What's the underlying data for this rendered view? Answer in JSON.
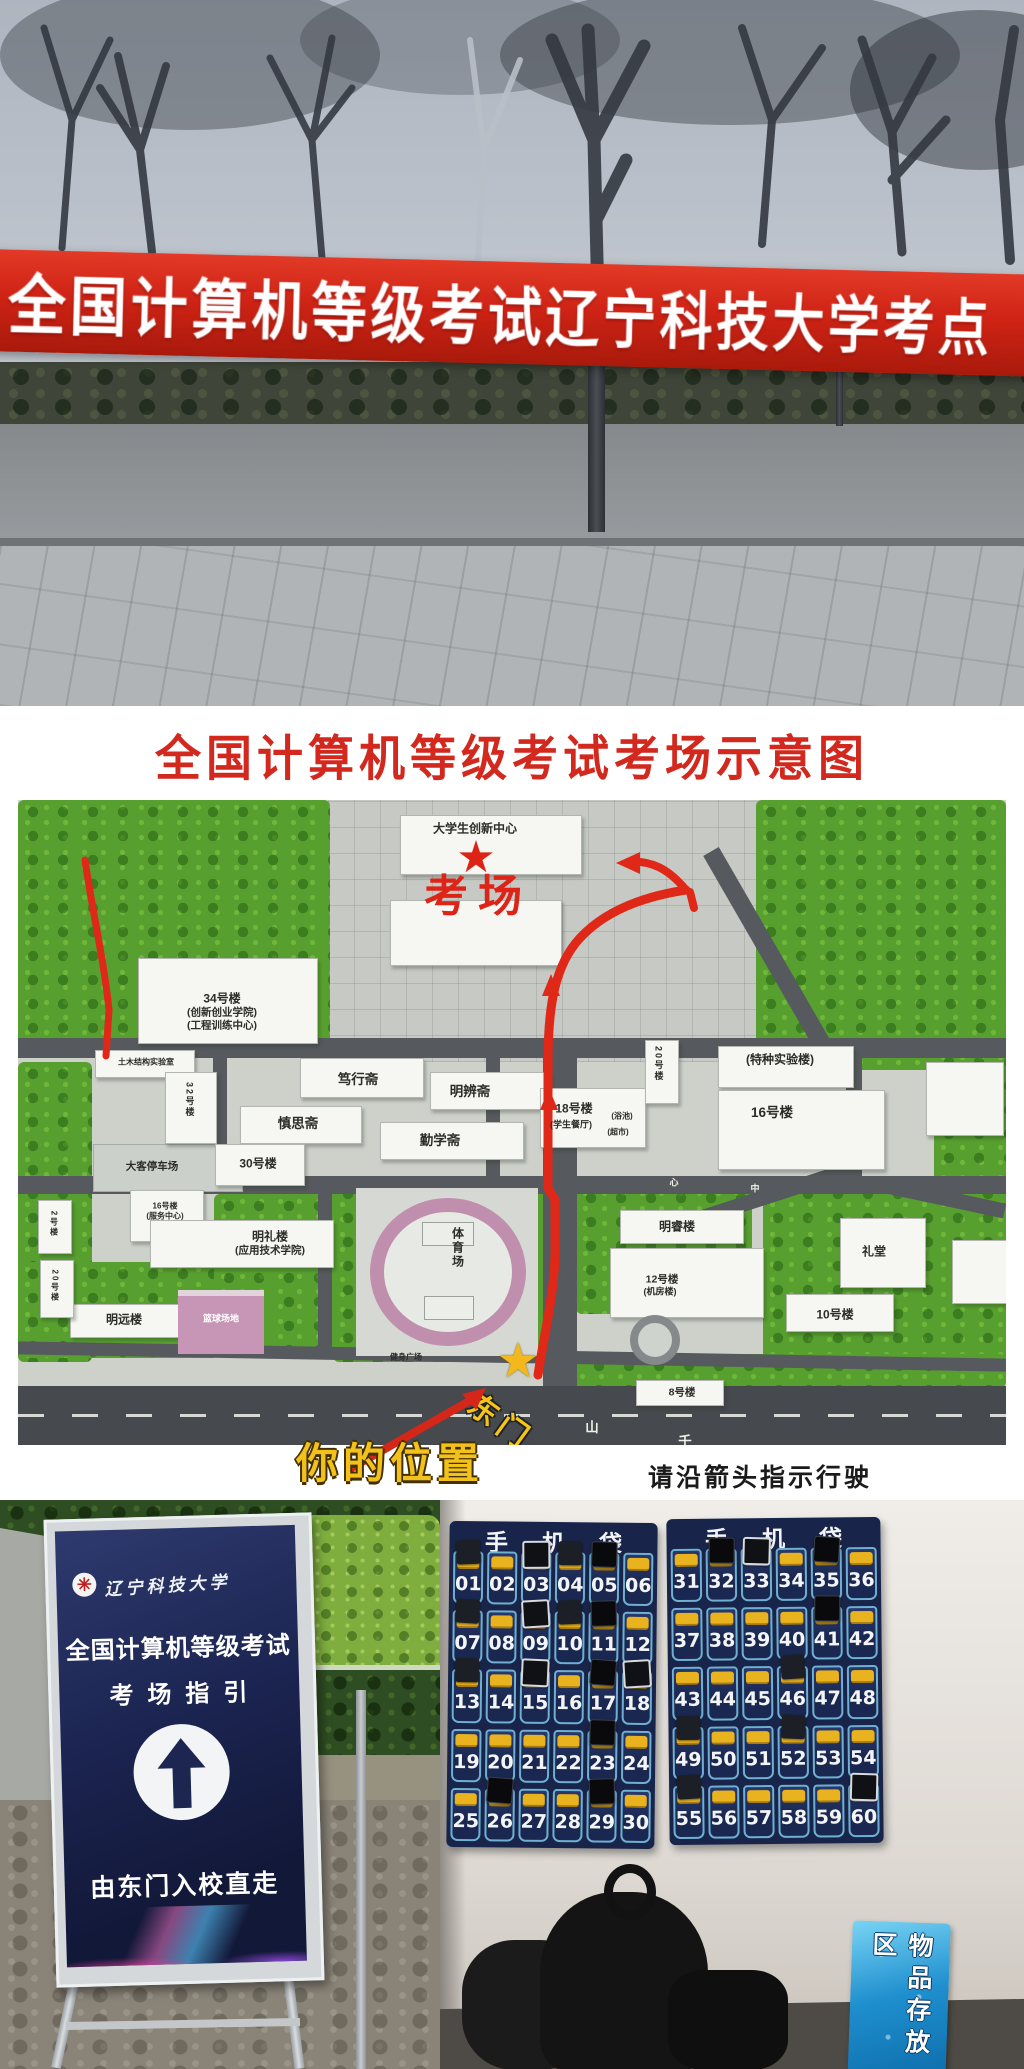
{
  "photo_banner": {
    "text": "全国计算机等级考试辽宁科技大学考点"
  },
  "map": {
    "title": "全国计算机等级考试考场示意图",
    "footer_note": "请沿箭头指示行驶",
    "exam_room": "考场",
    "east_gate": "东门",
    "your_location": "你的位置",
    "labels": [
      {
        "text": "大学生创新中心",
        "x": 457,
        "y": 28,
        "cls": "s11"
      },
      {
        "text": "34号楼",
        "x": 204,
        "y": 198,
        "cls": "s11"
      },
      {
        "text": "(创新创业学院)",
        "x": 204,
        "y": 212,
        "cls": "s10"
      },
      {
        "text": "(工程训练中心)",
        "x": 204,
        "y": 225,
        "cls": "s10"
      },
      {
        "text": "土木结构实验室",
        "x": 128,
        "y": 262,
        "cls": "s8"
      },
      {
        "text": "32号楼",
        "x": 172,
        "y": 300,
        "cls": "s9 vert"
      },
      {
        "text": "笃行斋",
        "x": 340,
        "y": 278,
        "cls": "s12"
      },
      {
        "text": "明辨斋",
        "x": 452,
        "y": 290,
        "cls": "s12"
      },
      {
        "text": "慎思斋",
        "x": 280,
        "y": 322,
        "cls": "s12"
      },
      {
        "text": "勤学斋",
        "x": 422,
        "y": 339,
        "cls": "s12"
      },
      {
        "text": "30号楼",
        "x": 240,
        "y": 363,
        "cls": "s11"
      },
      {
        "text": "大客停车场",
        "x": 134,
        "y": 366,
        "cls": "s10"
      },
      {
        "text": "16号楼",
        "x": 147,
        "y": 406,
        "cls": "s8"
      },
      {
        "text": "(服务中心)",
        "x": 147,
        "y": 416,
        "cls": "s8"
      },
      {
        "text": "18号楼",
        "x": 556,
        "y": 308,
        "cls": "s11"
      },
      {
        "text": "(学生餐厅)",
        "x": 553,
        "y": 324,
        "cls": "s9"
      },
      {
        "text": "(浴池)",
        "x": 604,
        "y": 316,
        "cls": "s8"
      },
      {
        "text": "(超市)",
        "x": 600,
        "y": 332,
        "cls": "s8"
      },
      {
        "text": "20号楼",
        "x": 641,
        "y": 264,
        "cls": "s9 vert"
      },
      {
        "text": "(特种实验楼)",
        "x": 762,
        "y": 259,
        "cls": "s11"
      },
      {
        "text": "16号楼",
        "x": 754,
        "y": 311,
        "cls": "s12"
      },
      {
        "text": "明礼楼",
        "x": 252,
        "y": 436,
        "cls": "s11"
      },
      {
        "text": "(应用技术学院)",
        "x": 252,
        "y": 450,
        "cls": "s10"
      },
      {
        "text": "明远楼",
        "x": 106,
        "y": 519,
        "cls": "s11"
      },
      {
        "text": "2号楼",
        "x": 36,
        "y": 424,
        "cls": "s8 vert"
      },
      {
        "text": "20号楼",
        "x": 37,
        "y": 486,
        "cls": "s8 vert"
      },
      {
        "text": "体育场",
        "x": 440,
        "y": 448,
        "cls": "s11 vert"
      },
      {
        "text": "篮球场地",
        "x": 203,
        "y": 518,
        "cls": "s9 pinktxt"
      },
      {
        "text": "健身广场",
        "x": 388,
        "y": 557,
        "cls": "s8"
      },
      {
        "text": "明睿楼",
        "x": 659,
        "y": 426,
        "cls": "s11"
      },
      {
        "text": "12号楼",
        "x": 644,
        "y": 479,
        "cls": "s10"
      },
      {
        "text": "(机房楼)",
        "x": 642,
        "y": 491,
        "cls": "s9"
      },
      {
        "text": "礼堂",
        "x": 856,
        "y": 451,
        "cls": "s11"
      },
      {
        "text": "10号楼",
        "x": 817,
        "y": 514,
        "cls": "s11"
      },
      {
        "text": "8号楼",
        "x": 664,
        "y": 592,
        "cls": "s10"
      },
      {
        "text": "心",
        "x": 656,
        "y": 382,
        "cls": "s9 roadtxt"
      },
      {
        "text": "中",
        "x": 737,
        "y": 388,
        "cls": "s9 roadtxt"
      },
      {
        "text": "山",
        "x": 574,
        "y": 626,
        "cls": "s12 roadtxt"
      },
      {
        "text": "千",
        "x": 667,
        "y": 640,
        "cls": "s12 roadtxt"
      }
    ]
  },
  "sign": {
    "university": "辽宁科技大学",
    "title_line1": "全国计算机等级考试",
    "title_line2": "考场指引",
    "direction": "由东门入校直走",
    "arrow_icon": "straight-ahead-arrow",
    "logo_icon": "university-seal"
  },
  "storage": {
    "header": "手机袋",
    "left_numbers": [
      "01",
      "02",
      "03",
      "04",
      "05",
      "06",
      "07",
      "08",
      "09",
      "10",
      "11",
      "12",
      "13",
      "14",
      "15",
      "16",
      "17",
      "18",
      "19",
      "20",
      "21",
      "22",
      "23",
      "24",
      "25",
      "26",
      "27",
      "28",
      "29",
      "30"
    ],
    "right_numbers": [
      "31",
      "32",
      "33",
      "34",
      "35",
      "36",
      "37",
      "38",
      "39",
      "40",
      "41",
      "42",
      "43",
      "44",
      "45",
      "46",
      "47",
      "48",
      "49",
      "50",
      "51",
      "52",
      "53",
      "54",
      "55",
      "56",
      "57",
      "58",
      "59",
      "60"
    ],
    "left_phones": [
      1,
      3,
      4,
      5,
      7,
      9,
      10,
      11,
      13,
      15,
      17,
      18,
      23,
      26,
      29
    ],
    "right_phones": [
      32,
      33,
      35,
      41,
      46,
      49,
      52,
      55,
      60
    ],
    "storage_sign": "物品存放区"
  },
  "colors": {
    "banner_red": "#cf2315",
    "title_red": "#d2281e",
    "route_red": "#e02818",
    "star_yellow": "#f2b81c",
    "board_navy": "#1b2450",
    "pouch_navy": "#18244a",
    "pouch_trim": "#6fb0d2",
    "elastic_yellow": "#e9b31f",
    "sign_blue": "#1f8fce",
    "grass_green": "#57a02f"
  }
}
